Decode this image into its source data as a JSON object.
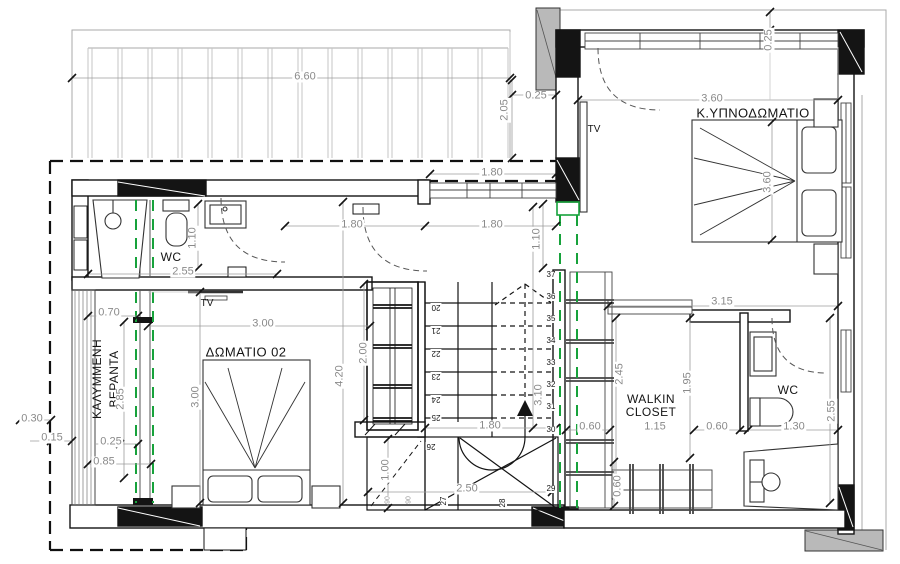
{
  "drawing": {
    "rooms": {
      "master_bedroom": "Κ.ΥΠΝΟΔΩΜΑΤΙΟ",
      "bedroom_02": "ΔΩΜΑΤΙΟ 02",
      "walkin_closet_1": "WALKIN",
      "walkin_closet_2": "CLOSET",
      "wc_left": "WC",
      "wc_right": "WC",
      "veranda_1": "ΚΑΛΥΜΜΕΝΗ",
      "veranda_2": "ΒΕΡΑΝΤΑ",
      "tv_hall": "TV",
      "tv_bedroom": "TV"
    },
    "dims": {
      "d660": "6.60",
      "d205": "2.05",
      "d025a": "0.25",
      "d360h": "3.60",
      "d025r": "0.25",
      "d360v": "3.60",
      "d180a": "1.80",
      "d180b": "1.80",
      "d180c": "1.80",
      "d110a": "1.10",
      "d110b": "1.10",
      "d255a": "2.55",
      "d070": "0.70",
      "d300h": "3.00",
      "d300v": "3.00",
      "d285": "2.85",
      "d030": "0.30",
      "d015": "0.15",
      "d025b": "0.25",
      "d085": "0.85",
      "d420": "4.20",
      "d200": "2.00",
      "d100": "1.00",
      "d250": "2.50",
      "d180d": "1.80",
      "d310": "3.10",
      "d060a": "0.60",
      "d315": "3.15",
      "d245": "2.45",
      "d195": "1.95",
      "d115": "1.15",
      "d060b": "0.60",
      "d130": "1.30",
      "d255b": "2.55",
      "d060c": "0.60"
    },
    "stair_steps": [
      "20",
      "21",
      "22",
      "23",
      "24",
      "25",
      "26",
      "27",
      "28",
      "29",
      "30",
      "31",
      "32",
      "33",
      "34",
      "35",
      "36",
      "37"
    ],
    "riser_marks": [
      "90",
      "90"
    ],
    "colors": {
      "window_green": "#17a23b",
      "slab_gray": "#b9b9b9",
      "dim_text": "#8a8a8a",
      "line_black": "#141414"
    }
  }
}
